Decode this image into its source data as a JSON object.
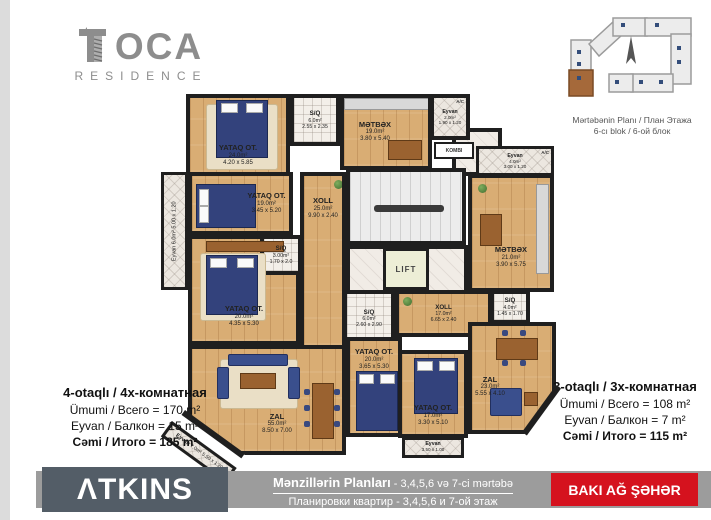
{
  "logo": {
    "oca": "OCA",
    "residence": "RESIDENCE"
  },
  "site_plan": {
    "caption1": "Mərtəbənin Planı / План Этажа",
    "caption2": "6-cı blok / 6-ой блок"
  },
  "info_left": {
    "title": "4-otaqlı / 4х-комнатная",
    "line1": "Ümumi / Всего = 170 m²",
    "line2": "Eyvan / Балкон = 15 m²",
    "line3": "Cəmi / Итого = 185 m²"
  },
  "info_right": {
    "title": "3-otaqlı / 3х-комнатная",
    "line1": "Ümumi / Всего = 108 m²",
    "line2": "Eyvan / Балкон = 7 m²",
    "line3": "Cəmi / Итого = 115 m²"
  },
  "footer": {
    "brand": "ΛTKINS",
    "title": "Mənzillərin Planları",
    "title_suffix": " - 3,4,5,6 və 7-ci mərtəbə",
    "subtitle": "Планировки квартир - 3,4,5,6 и 7-ой этаж",
    "badge": "BAKI AĞ ŞƏHƏR"
  },
  "plan": {
    "lift": "LIFT",
    "kombi": "KOMBI",
    "ac": "A/C",
    "rooms": [
      {
        "name": "YATAQ OT.",
        "area": "24.0m²",
        "dims": "4.20 x 5.85"
      },
      {
        "name": "S/Q",
        "area": "6.0m²",
        "dims": "2.55 x 2.35"
      },
      {
        "name": "MƏTBƏX",
        "area": "19.0m²",
        "dims": "3.80 x 5.40"
      },
      {
        "name": "Eyvan",
        "area": "2.0m²",
        "dims": "1.90 x 1.20"
      },
      {
        "name": "YATAQ OT.",
        "area": "19.0m²",
        "dims": "3.45 x 5.20"
      },
      {
        "name": "XOLL",
        "area": "25.0m²",
        "dims": "9.90 x 2.40"
      },
      {
        "name": "S/Q",
        "area": "3.00m²",
        "dims": "1.70 x 2.0"
      },
      {
        "name": "YATAQ OT.",
        "area": "20.0m²",
        "dims": "4.35 x 5.30"
      },
      {
        "name": "ZAL",
        "area": "55.0m²",
        "dims": "8.50 x 7.00"
      },
      {
        "name": "Eyvan",
        "area": "6.0m²",
        "dims": "5.00 x 1.20"
      },
      {
        "name": "Eyvan",
        "area": "7.0m²",
        "dims": "5.50 x 1.20"
      },
      {
        "name": "Eyvan",
        "area": "4.0m²",
        "dims": "3.00 x 1.20"
      },
      {
        "name": "MƏTBƏX",
        "area": "21.0m²",
        "dims": "3.90 x 5.75"
      },
      {
        "name": "S/Q",
        "area": "6.0m²",
        "dims": "2.60 x 2.90"
      },
      {
        "name": "XOLL",
        "area": "17.0m²",
        "dims": "6.65 x 2.40"
      },
      {
        "name": "YATAQ OT.",
        "area": "20.0m²",
        "dims": "3.65 x 5.30"
      },
      {
        "name": "YATAQ OT.",
        "area": "17.0m²",
        "dims": "3.30 x 5.10"
      },
      {
        "name": "S/Q",
        "area": "4.0m²",
        "dims": "1.45 x 1.70"
      },
      {
        "name": "ZAL",
        "area": "23.0m²",
        "dims": "5.55 x 4.10"
      },
      {
        "name": "Eyvan",
        "area": "3.0m²",
        "dims": "3.50 x 1.00"
      }
    ]
  }
}
